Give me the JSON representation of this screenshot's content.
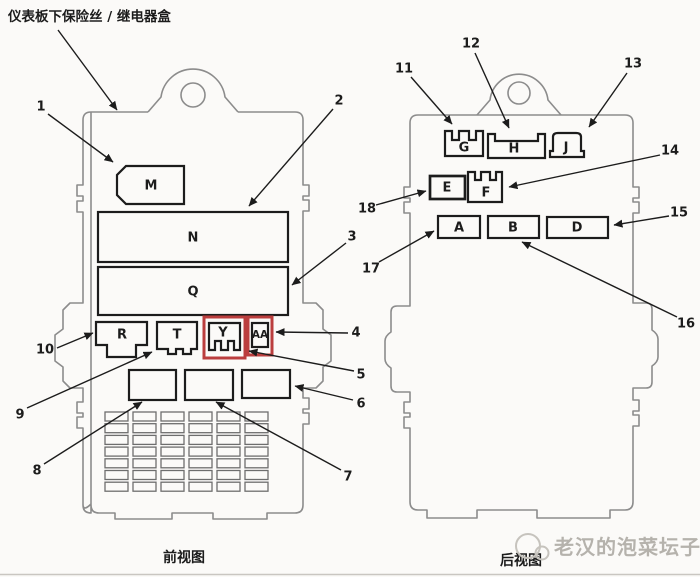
{
  "title": "仪表板下保险丝 / 继电器盒",
  "front_view": {
    "caption": "前视图",
    "blocks": {
      "m": "M",
      "n": "N",
      "q": "Q",
      "r": "R",
      "t": "T",
      "y": "Y",
      "aa": "AA"
    },
    "callouts": {
      "c1": "1",
      "c2": "2",
      "c3": "3",
      "c4": "4",
      "c5": "5",
      "c6": "6",
      "c7": "7",
      "c8": "8",
      "c9": "9",
      "c10": "10"
    },
    "fuse_grid": {
      "rows": 7,
      "cols": 6
    }
  },
  "rear_view": {
    "caption": "后视图",
    "blocks": {
      "g": "G",
      "h": "H",
      "j": "J",
      "e": "E",
      "f": "F",
      "a": "A",
      "b": "B",
      "d": "D"
    },
    "callouts": {
      "c11": "11",
      "c12": "12",
      "c13": "13",
      "c14": "14",
      "c15": "15",
      "c16": "16",
      "c17": "17",
      "c18": "18"
    }
  },
  "watermark": {
    "text": "老汉的泡菜坛子"
  },
  "colors": {
    "line": "#1c1c1c",
    "body_outline": "#8c8c8c",
    "highlight": "#bb3e3e",
    "watermark": "#b5b2ac",
    "background": "#fbfaf8"
  }
}
